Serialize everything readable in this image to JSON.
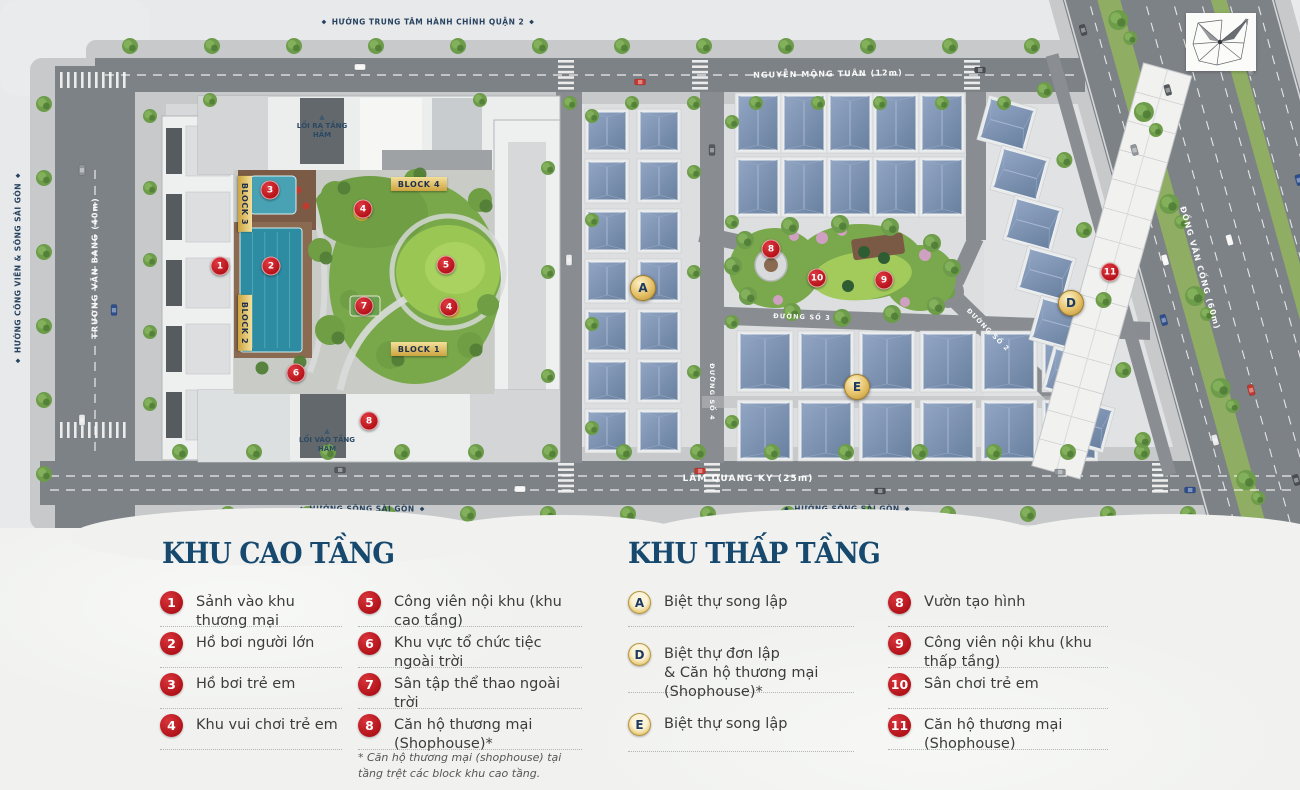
{
  "map": {
    "direction_labels": [
      {
        "text": "HƯỚNG TRUNG TÂM HÀNH CHÍNH QUẬN 2",
        "x": 428,
        "y": 22,
        "rotate": 0
      },
      {
        "text": "HƯỚNG CÔNG VIÊN & SÔNG SÀI GÒN",
        "x": 18,
        "y": 268,
        "rotate": -90
      },
      {
        "text": "HƯỚNG SÔNG SÀI GÒN",
        "x": 362,
        "y": 509,
        "rotate": 0
      },
      {
        "text": "HƯỚNG SÔNG SÀI GÒN",
        "x": 847,
        "y": 509,
        "rotate": 0
      }
    ],
    "road_labels": [
      {
        "text": "NGUYỄN MỘNG TUÂN (12m)",
        "x": 828,
        "y": 74,
        "rotate": -1,
        "size": 8
      },
      {
        "text": "TRƯƠNG VĂN BANG (40m)",
        "x": 95,
        "y": 268,
        "rotate": -90,
        "size": 8
      },
      {
        "text": "LÂM QUANG KY (25m)",
        "x": 748,
        "y": 479,
        "rotate": 0,
        "size": 9
      },
      {
        "text": "ĐỒNG VĂN CỐNG (60m)",
        "x": 1200,
        "y": 268,
        "rotate": 74,
        "size": 8
      },
      {
        "text": "ĐƯỜNG SỐ 3",
        "x": 802,
        "y": 317,
        "rotate": 2,
        "size": 6.5
      },
      {
        "text": "ĐƯỜNG SỐ 2",
        "x": 988,
        "y": 330,
        "rotate": 45,
        "size": 6.5
      },
      {
        "text": "ĐƯỜNG SỐ 4",
        "x": 712,
        "y": 392,
        "rotate": 90,
        "size": 6.5
      }
    ],
    "access_labels": [
      {
        "text": "LỐI RA TẦNG HẦM",
        "x": 322,
        "y": 127
      },
      {
        "text": "LỐI VÀO TẦNG HẦM",
        "x": 327,
        "y": 441
      }
    ],
    "block_labels": [
      {
        "text": "BLOCK 4",
        "x": 419,
        "y": 184,
        "rotate": 0
      },
      {
        "text": "BLOCK 1",
        "x": 419,
        "y": 349,
        "rotate": 0
      },
      {
        "text": "BLOCK 3",
        "x": 245,
        "y": 204,
        "rotate": 90
      },
      {
        "text": "BLOCK 2",
        "x": 245,
        "y": 323,
        "rotate": 90
      }
    ],
    "red_markers": [
      {
        "label": "1",
        "x": 220,
        "y": 266
      },
      {
        "label": "2",
        "x": 271,
        "y": 266
      },
      {
        "label": "3",
        "x": 270,
        "y": 190
      },
      {
        "label": "4",
        "x": 363,
        "y": 209
      },
      {
        "label": "5",
        "x": 446,
        "y": 265
      },
      {
        "label": "4",
        "x": 449,
        "y": 307
      },
      {
        "label": "7",
        "x": 364,
        "y": 306
      },
      {
        "label": "6",
        "x": 296,
        "y": 373
      },
      {
        "label": "8",
        "x": 369,
        "y": 421
      },
      {
        "label": "8",
        "x": 771,
        "y": 249
      },
      {
        "label": "10",
        "x": 817,
        "y": 278
      },
      {
        "label": "9",
        "x": 884,
        "y": 280
      },
      {
        "label": "11",
        "x": 1110,
        "y": 272
      }
    ],
    "gold_markers": [
      {
        "label": "A",
        "x": 643,
        "y": 288
      },
      {
        "label": "E",
        "x": 857,
        "y": 387
      },
      {
        "label": "D",
        "x": 1071,
        "y": 303
      }
    ]
  },
  "legend": {
    "high_rise": {
      "title": "KHU CAO TẦNG",
      "items": [
        {
          "num": "1",
          "label": "Sảnh vào khu thương mại"
        },
        {
          "num": "2",
          "label": "Hồ bơi người lớn"
        },
        {
          "num": "3",
          "label": "Hồ bơi trẻ em"
        },
        {
          "num": "4",
          "label": "Khu vui chơi trẻ em"
        },
        {
          "num": "5",
          "label": "Công viên nội khu (khu cao tầng)"
        },
        {
          "num": "6",
          "label": "Khu vực tổ chức tiệc ngoài trời"
        },
        {
          "num": "7",
          "label": "Sân tập thể thao ngoài trời"
        },
        {
          "num": "8",
          "label": "Căn hộ thương mại (Shophouse)*"
        }
      ],
      "footnote": "* Căn hộ thương mại (shophouse) tại tầng trệt các block khu cao tầng."
    },
    "low_rise": {
      "title": "KHU THẤP TẦNG",
      "letter_items": [
        {
          "key": "A",
          "label": "Biệt thự song lập",
          "label2": ""
        },
        {
          "key": "D",
          "label": "Biệt thự đơn lập",
          "label2": "& Căn hộ thương mại (Shophouse)*"
        },
        {
          "key": "E",
          "label": "Biệt thự song lập",
          "label2": ""
        }
      ],
      "number_items": [
        {
          "num": "8",
          "label": "Vườn tạo hình"
        },
        {
          "num": "9",
          "label": "Công viên nội khu (khu thấp tầng)"
        },
        {
          "num": "10",
          "label": "Sân chơi trẻ em"
        },
        {
          "num": "11",
          "label": "Căn hộ thương mại (Shophouse)"
        }
      ]
    }
  },
  "colors": {
    "marker_red": "#c4161c",
    "gold_light": "#f3e09a",
    "gold_dark": "#c49a3a",
    "navy_title": "#17496f",
    "road_gray": "#7d8286",
    "villa_roof": "#7b90b0",
    "pool_teal": "#2e8ca2",
    "lawn_green": "#9ac653"
  }
}
